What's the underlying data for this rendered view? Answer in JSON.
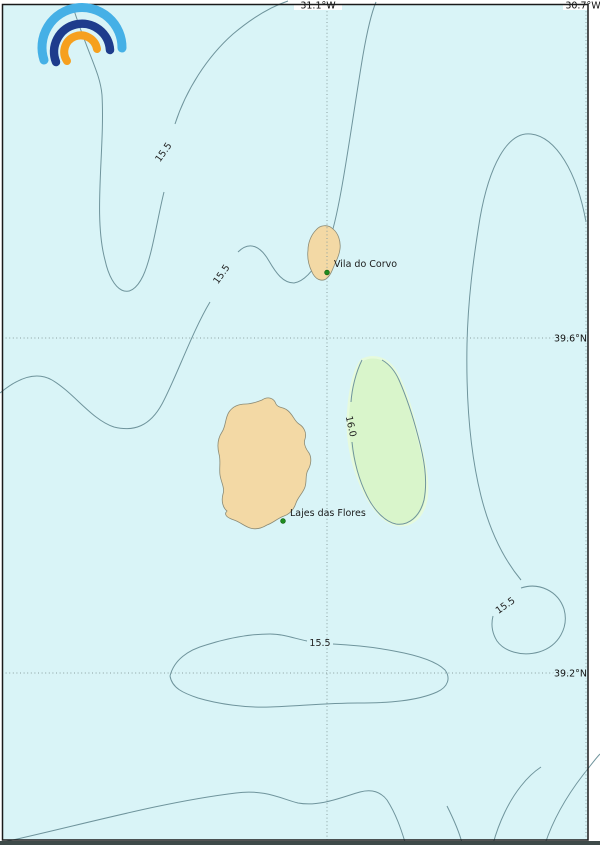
{
  "axes": {
    "top_labels": [
      {
        "text": "31.1°W"
      },
      {
        "text": "30.7°W"
      }
    ],
    "right_labels": [
      {
        "text": "39.6°N"
      },
      {
        "text": "39.2°N"
      }
    ]
  },
  "places": [
    {
      "name": "Vila do Corvo"
    },
    {
      "name": "Lajes das Flores"
    }
  ],
  "contour_labels": [
    {
      "text": "15.5"
    },
    {
      "text": "15.5"
    },
    {
      "text": "15.5"
    },
    {
      "text": "15.5"
    },
    {
      "text": "16.0"
    }
  ],
  "colors": {
    "sea": "#d9f4f7",
    "land": "#f3d9a5",
    "warm_patch": "#d9f5cb",
    "contour_line": "#6f949c",
    "grid_line": "#8aa0a0",
    "marker_green": "#1f8c1f",
    "frame": "#1a1a1a",
    "bottom_bar": "#3e4a49",
    "logo_light_blue": "#45b0e6",
    "logo_dark_blue": "#1e3c8c",
    "logo_orange": "#f6a01e"
  }
}
